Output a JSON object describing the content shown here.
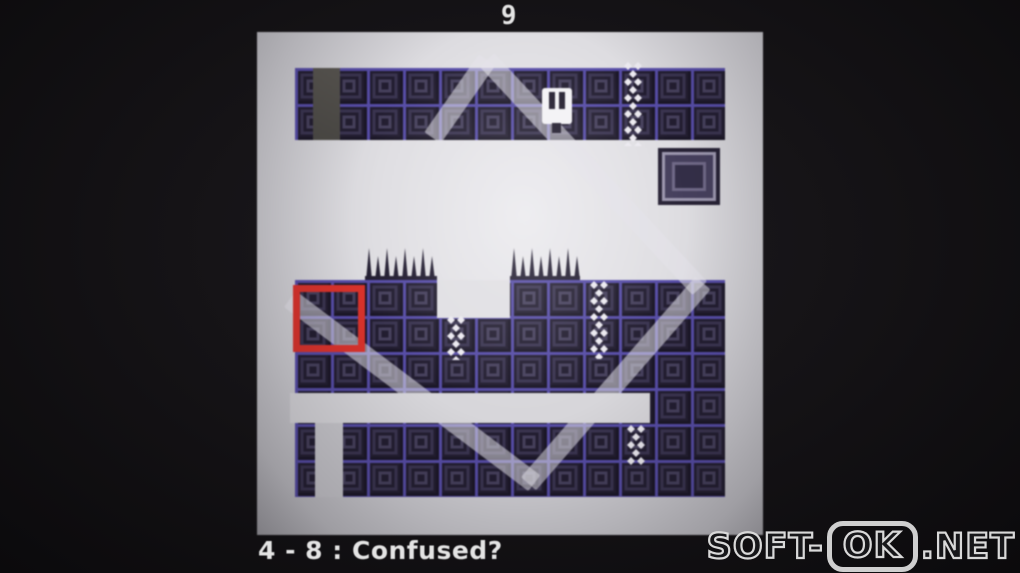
{
  "hud": {
    "top_counter": "9",
    "room_label": "4 - 8 : Confused?"
  },
  "watermark": {
    "prefix": "SOFT-",
    "boxed": "OK",
    "suffix": ".NET"
  },
  "colors": {
    "accent_red": "#d8322b",
    "tile_grid": "#564ca6",
    "tile_base": "#1a1626",
    "spike": "#211c30",
    "chain_white": "#eceaf0",
    "room_glow": "#eae9ed",
    "hud_text": "#e4e4e4",
    "beam": "rgba(228,226,234,0.55)",
    "background": "#141215"
  }
}
